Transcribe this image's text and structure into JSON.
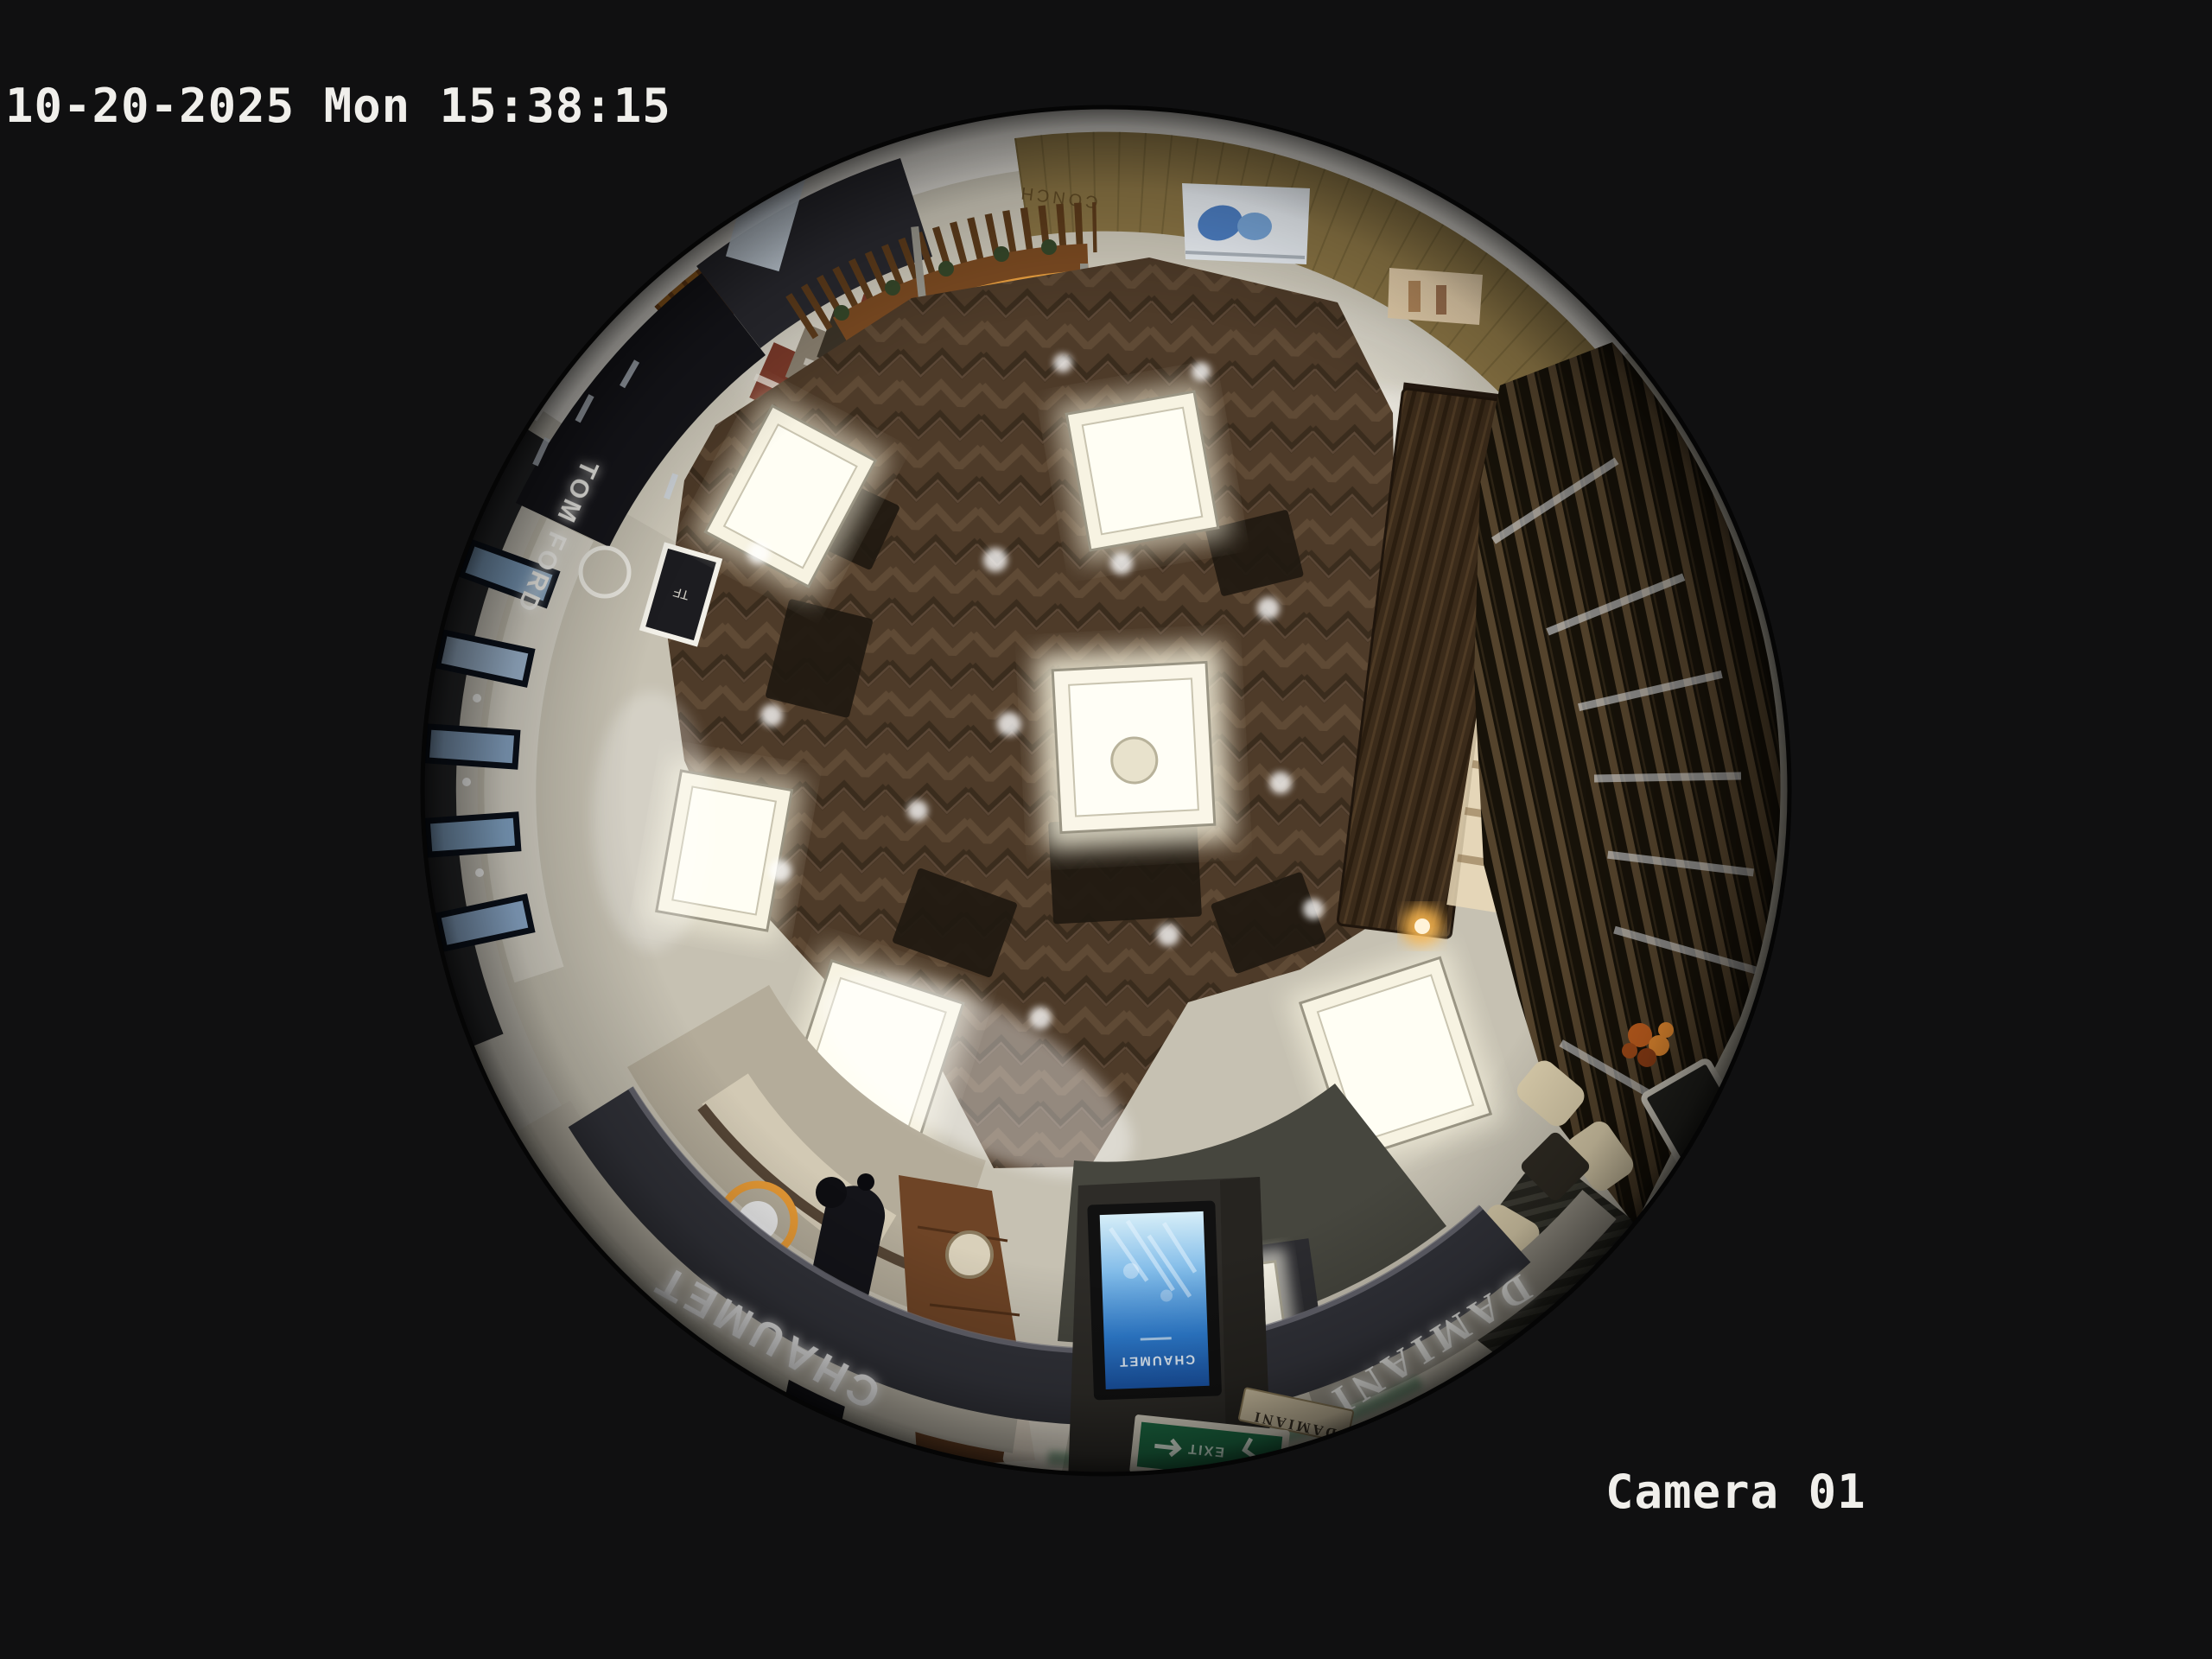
{
  "osd": {
    "timestamp": "10-20-2025 Mon 15:38:15",
    "camera_label": "Camera 01"
  },
  "fisheye": {
    "signs": {
      "chaumet_fascia": "CHAUMET",
      "damiani_fascia": "DAMIANI",
      "tom_ford": "TOM FORD",
      "tf_monogram": "TF",
      "kiosk_screen_brand": "CHAUMET",
      "damiani_small_sign": "DAMIANI",
      "exit_sign": "EXIT",
      "ceiling_sign": "CONCH"
    },
    "colors": {
      "background": "#101011",
      "osd_text": "#f0efeb",
      "stone_floor": "#c6c1b2",
      "corridor_floor": "#d0cbbc",
      "wood_floor": "#4e3b29",
      "fascia_dark": "#32333a",
      "balustrade_wood": "#7c4b22",
      "led_amber": "#f5a844",
      "gold_ceiling": "#8d7746",
      "screen_blue": "#2e7ed2",
      "exit_green": "#1d6f46",
      "counter_glow_blue": "#a9cdf2",
      "case_light": "#f7f3e2"
    }
  }
}
